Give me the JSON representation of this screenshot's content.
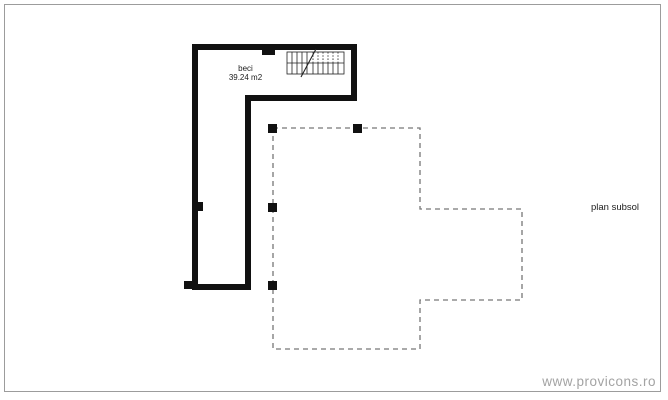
{
  "plan": {
    "caption": "plan subsol",
    "room": {
      "name": "beci",
      "area": "39.24 m2"
    }
  },
  "watermark": "www.provicons.ro",
  "icons": {
    "stairs": "stairs-icon"
  },
  "colors": {
    "background": "#ffffff",
    "wall": "#111111",
    "column": "#111111",
    "dashed_outline": "#777777",
    "frame_border": "#9c9c9c",
    "watermark_text": "#a3a3a3",
    "label_text": "#1c1c1c"
  }
}
